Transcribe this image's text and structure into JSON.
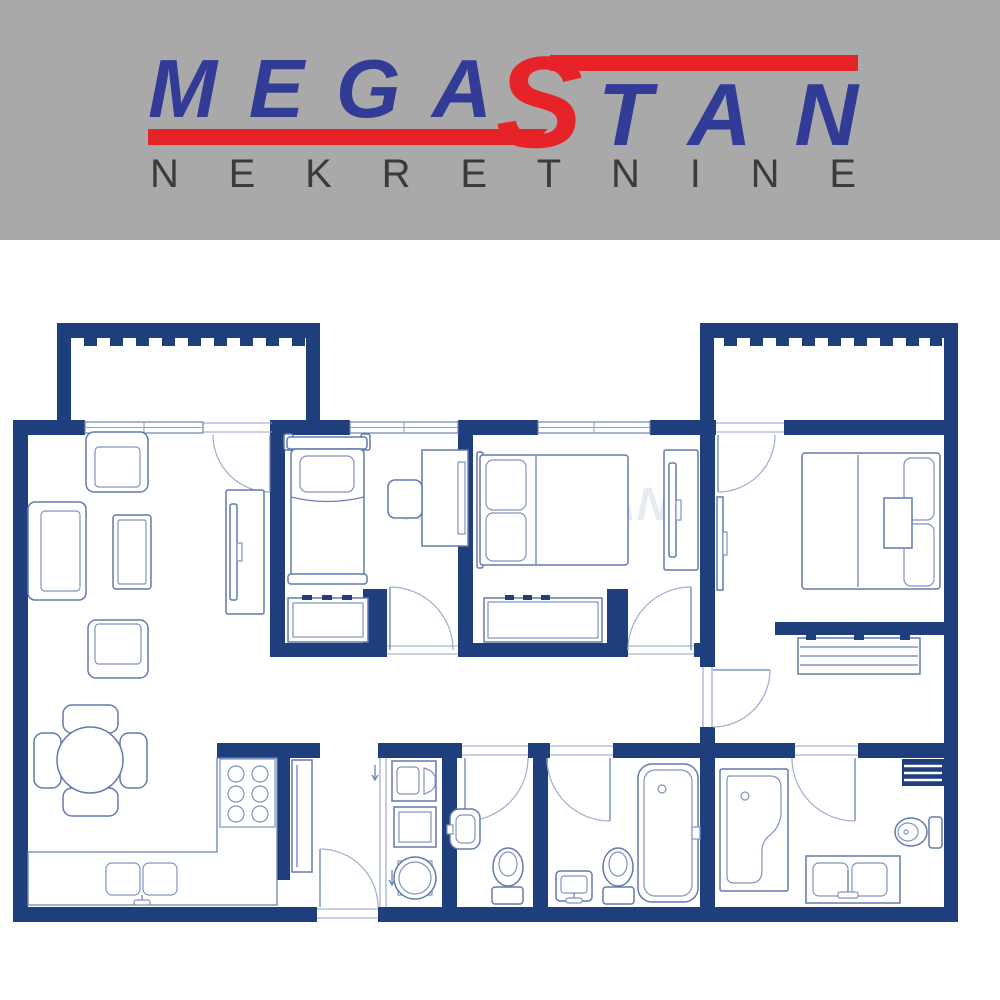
{
  "brand": {
    "word_part1": "MEGA",
    "word_part2": "S",
    "word_part3": "TAN",
    "subtitle": "NEKRETNINE",
    "colors": {
      "banner_bg": "#a9a9a9",
      "logo_blue": "#323c96",
      "logo_red": "#e62329",
      "subtitle_text": "#3b3b3b"
    }
  },
  "floorplan": {
    "watermark": "MEGASTAN",
    "watermark_sub": "NEKRETNINE",
    "colors": {
      "wall": "#1e3e7c",
      "furniture_line": "#637aad",
      "light_line": "#8093bd",
      "door_arc": "#a3b1d1",
      "background": "#ffffff"
    }
  }
}
